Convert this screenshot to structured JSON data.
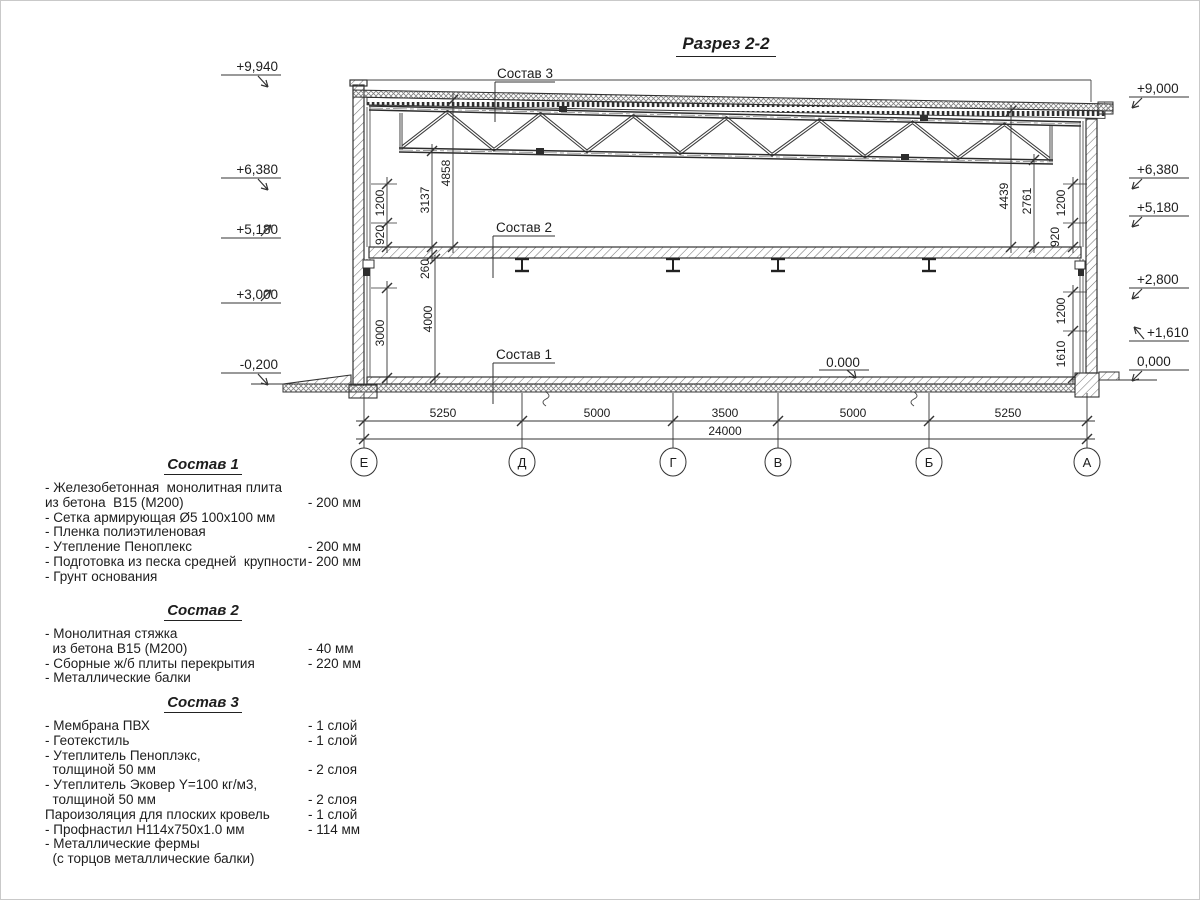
{
  "title": "Разрез 2-2",
  "drawing": {
    "callout_3": "Состав 3",
    "callout_2": "Состав 2",
    "callout_1": "Состав 1",
    "zero_label": "0.000",
    "elev_left": [
      "+9,940",
      "+6,380",
      "+5,180",
      "+3,000",
      "-0,200"
    ],
    "elev_right": [
      "+9,000",
      "+6,380",
      "+5,180",
      "+2,800",
      "+1,610",
      "0,000"
    ],
    "vdims_left": [
      "1200",
      "920",
      "3137",
      "4858",
      "260",
      "4000",
      "3000"
    ],
    "vdims_right": [
      "4439",
      "2761",
      "1200",
      "920",
      "1200",
      "1610"
    ],
    "hdims": [
      "5250",
      "5000",
      "3500",
      "5000",
      "5250"
    ],
    "total": "24000",
    "axes": [
      "Е",
      "Д",
      "Г",
      "В",
      "Б",
      "А"
    ]
  },
  "compositions": [
    {
      "title": "Состав 1",
      "items": [
        {
          "label": "- Железобетонная  монолитная плита",
          "value": ""
        },
        {
          "label": "из бетона  В15 (М200)",
          "value": "- 200 мм"
        },
        {
          "label": "- Сетка армирующая Ø5 100х100 мм",
          "value": ""
        },
        {
          "label": "- Пленка полиэтиленовая",
          "value": ""
        },
        {
          "label": "- Утепление Пеноплекс",
          "value": "- 200 мм"
        },
        {
          "label": "- Подготовка из песка средней  крупности",
          "value": "- 200 мм"
        },
        {
          "label": "- Грунт основания",
          "value": ""
        }
      ]
    },
    {
      "title": "Состав 2",
      "items": [
        {
          "label": "- Монолитная стяжка",
          "value": ""
        },
        {
          "label": "  из бетона В15 (М200)",
          "value": "- 40 мм"
        },
        {
          "label": "- Сборные ж/б плиты перекрытия",
          "value": "- 220 мм"
        },
        {
          "label": "- Металлические балки",
          "value": ""
        }
      ]
    },
    {
      "title": "Состав 3",
      "items": [
        {
          "label": "- Мембрана ПВХ",
          "value": "- 1 слой"
        },
        {
          "label": "- Геотекстиль",
          "value": "- 1 слой"
        },
        {
          "label": "- Утеплитель Пеноплэкс,",
          "value": ""
        },
        {
          "label": "  толщиной 50 мм",
          "value": "- 2 слоя"
        },
        {
          "label": "- Утеплитель Эковер Y=100 кг/м3,",
          "value": ""
        },
        {
          "label": "  толщиной 50 мм",
          "value": "- 2 слоя"
        },
        {
          "label": "Пароизоляция для плоских кровель",
          "value": "- 1 слой"
        },
        {
          "label": "- Профнастил Н114х750х1.0 мм",
          "value": "- 114 мм"
        },
        {
          "label": "- Металлические фермы",
          "value": ""
        },
        {
          "label": "  (с торцов металлические балки)",
          "value": ""
        }
      ]
    }
  ]
}
